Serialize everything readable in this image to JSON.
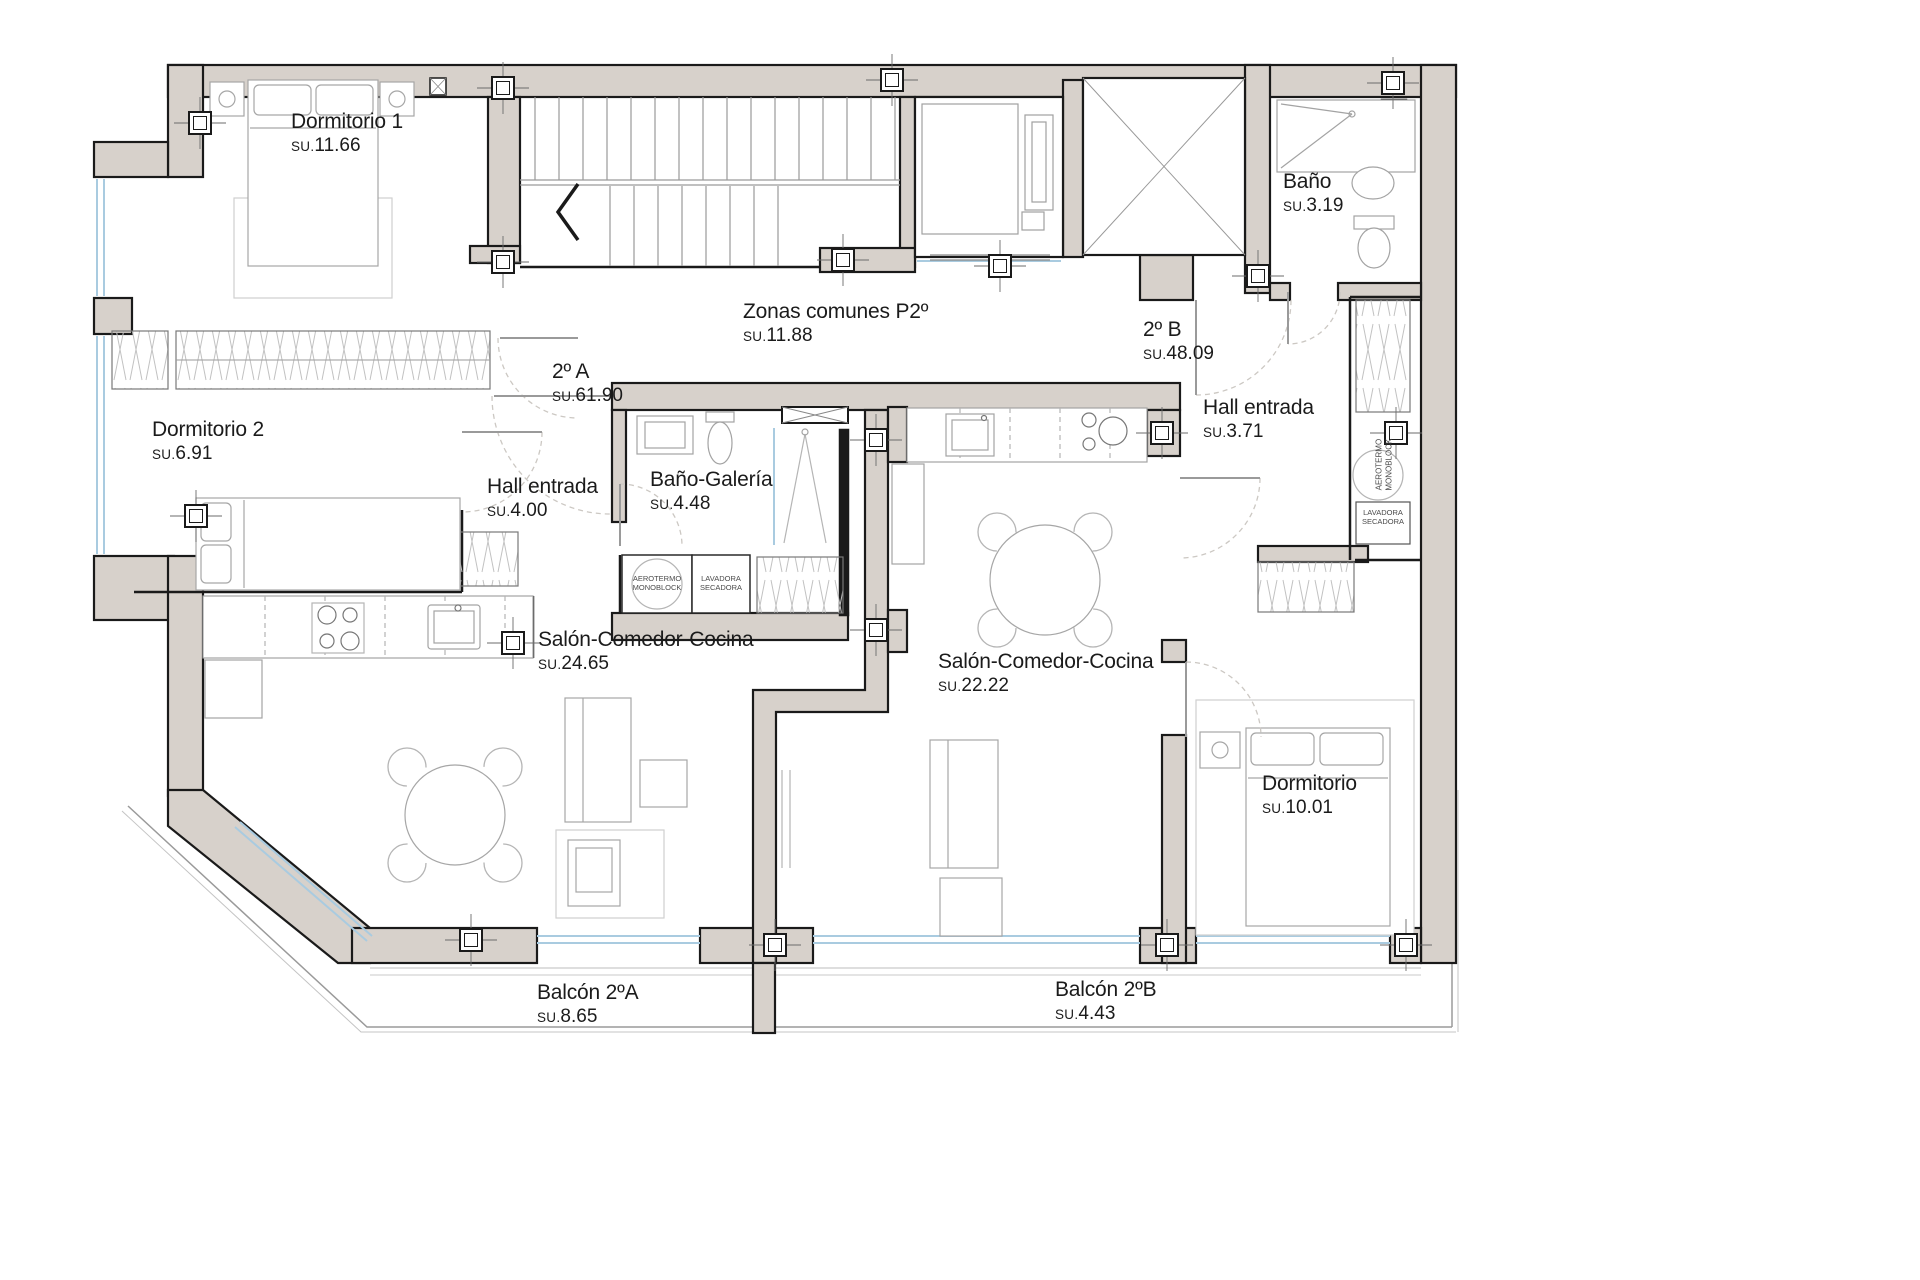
{
  "plan": {
    "su_prefix": "SU.",
    "colors": {
      "wall_fill": "#d7d1cb",
      "outline": "#1a1a1a",
      "furniture": "#a6a6a6",
      "window": "#a9cbe0",
      "door_arc": "#ccc8c3"
    },
    "rooms": [
      {
        "name": "Dormitorio 1",
        "su": "11.66"
      },
      {
        "name": "Dormitorio 2",
        "su": "6.91"
      },
      {
        "name": "2º A",
        "su": "61.90"
      },
      {
        "name": "Hall entrada",
        "su": "4.00"
      },
      {
        "name": "Baño-Galería",
        "su": "4.48"
      },
      {
        "name": "Salón-Comedor-Cocina",
        "su": "24.65"
      },
      {
        "name": "Balcón 2ºA",
        "su": "8.65"
      },
      {
        "name": "Zonas comunes P2º",
        "su": "11.88"
      },
      {
        "name": "2º B",
        "su": "48.09"
      },
      {
        "name": "Baño",
        "su": "3.19"
      },
      {
        "name": "Hall entrada",
        "su": "3.71"
      },
      {
        "name": "Salón-Comedor-Cocina",
        "su": "22.22"
      },
      {
        "name": "Dormitorio",
        "su": "10.01"
      },
      {
        "name": "Balcón 2ºB",
        "su": "4.43"
      }
    ],
    "appliances": {
      "aerotermo": "AEROTERMO MONOBLOCK",
      "lavadora": "LAVADORA SECADORA"
    }
  }
}
